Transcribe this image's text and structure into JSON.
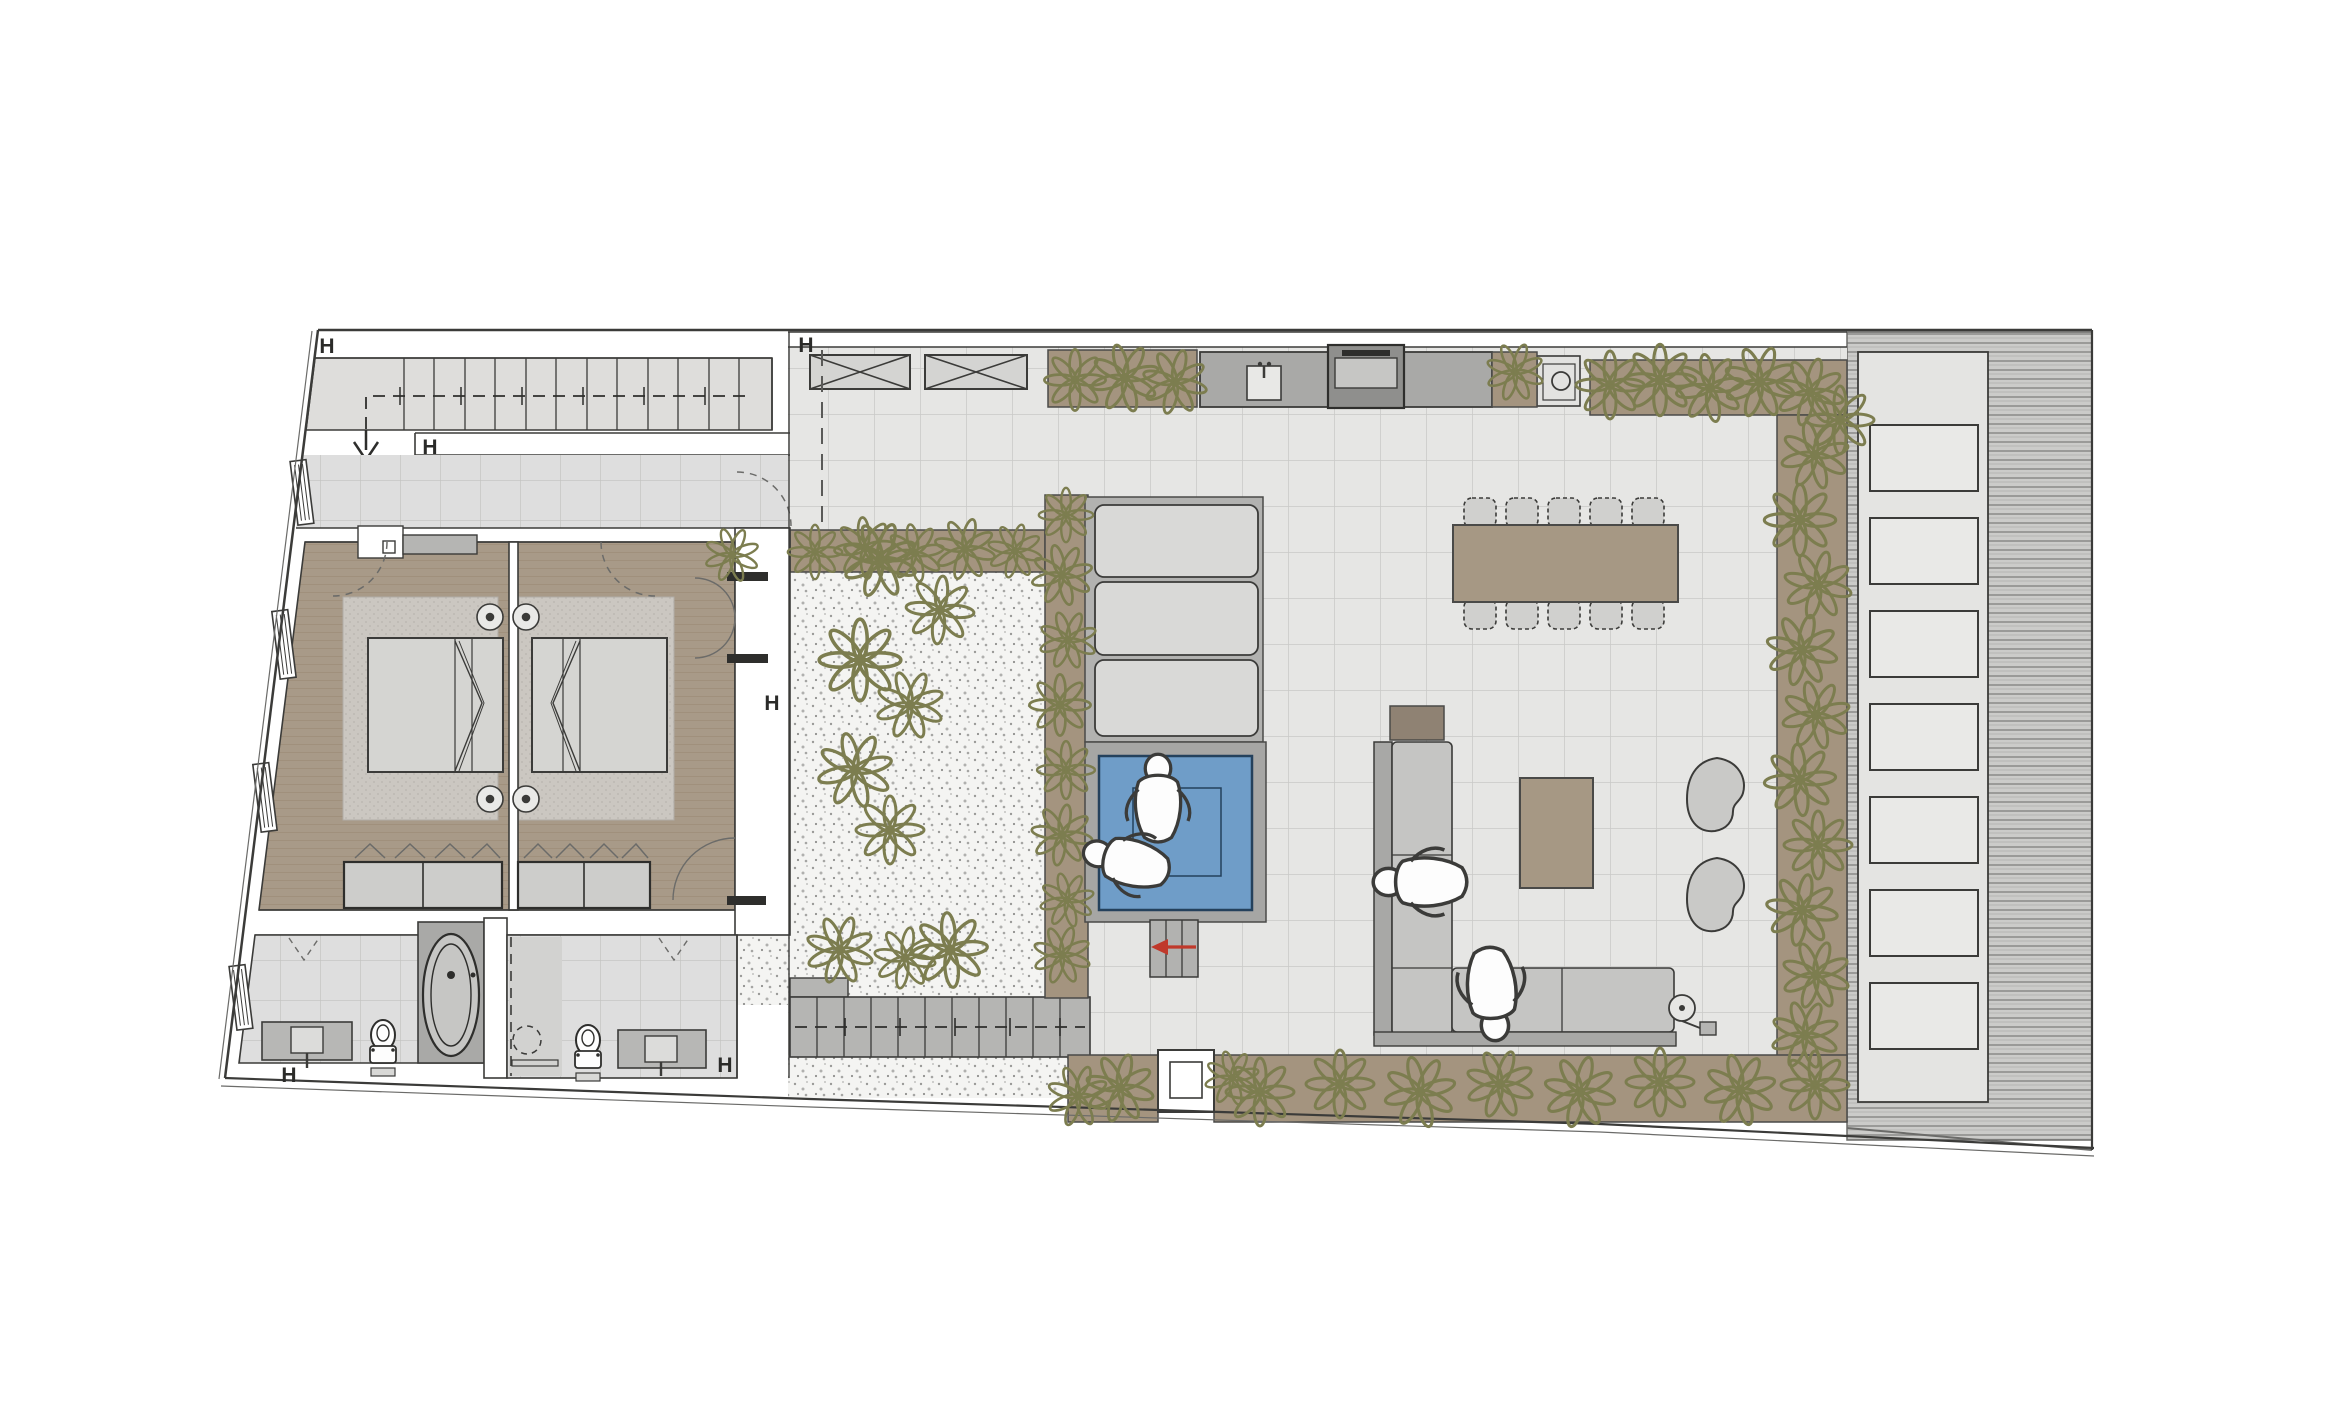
{
  "markers": {
    "wall_label": "H",
    "instances": 6
  },
  "colors": {
    "accent_red": "#c0392b",
    "pool_water": "#6f9dc8",
    "plant_olive": "#7c7d4f",
    "planter_soil": "#a4947f",
    "wood_floor": "#a89a88",
    "terrace_tile": "#e6e6e4",
    "deck_gray": "#b2b2b0",
    "furniture_taupe": "#a69884",
    "sofa_gray": "#c5c5c3",
    "line_dark": "#3b3b39"
  },
  "symbols": {
    "stairs_up": "staircase-icon",
    "stairs_garden": "garden-stairs-icon",
    "bed": "double-bed-icon",
    "bedside_lamp": "bedside-lamp-icon",
    "wardrobe": "wardrobe-icon",
    "bathtub": "bathtub-icon",
    "toilet": "toilet-icon",
    "vanity_sink": "vanity-sink-icon",
    "shower": "shower-icon",
    "pool": "plunge-pool-icon",
    "sun_lounger": "sun-lounger-icon",
    "dining_table": "dining-table-icon",
    "dining_chair": "dining-chair-icon",
    "sofa": "corner-sofa-icon",
    "coffee_table": "coffee-table-icon",
    "pouf": "pouf-icon",
    "floor_lamp": "floor-lamp-icon",
    "kitchen_sink": "kitchen-sink-icon",
    "bbq": "bbq-grill-icon",
    "skylight": "skylight-icon",
    "plant": "plant-cluster-icon",
    "person": "person-top-view-icon",
    "direction_arrow": "red-arrow-icon"
  }
}
